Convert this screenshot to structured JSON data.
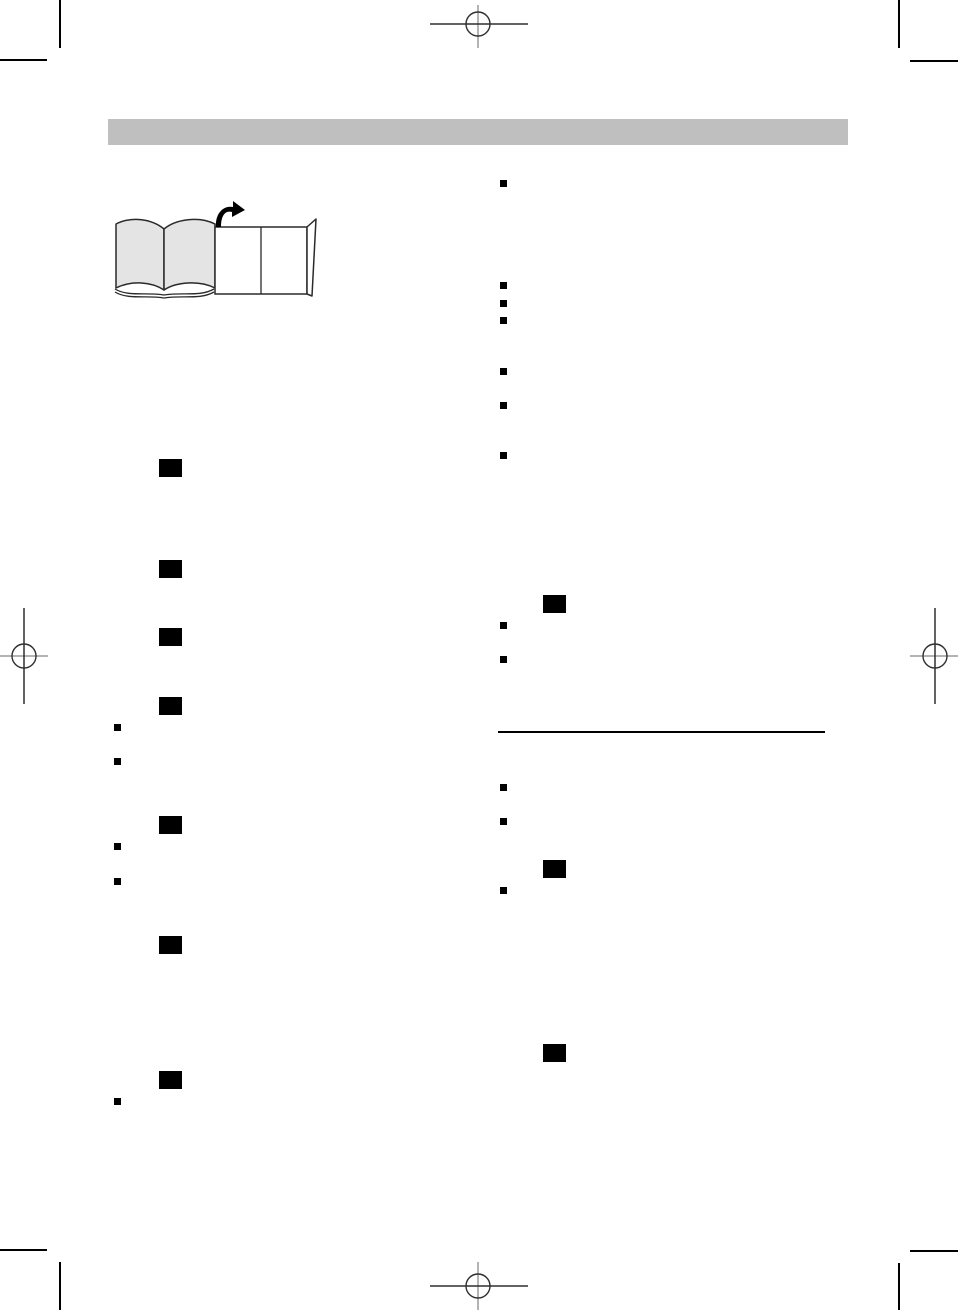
{
  "page": {
    "width": 958,
    "height": 1310,
    "background": "#ffffff"
  },
  "colors": {
    "header_bar": "#bfbfbf",
    "ink": "#000000",
    "crop_mark_dark": "#2f2f2f",
    "crop_mark_gray": "#b3b3b3",
    "illustration_page_fill": "#e4e4e4",
    "foldout_fill": "#ffffff"
  },
  "header_bar": {
    "x": 108,
    "y": 119,
    "width": 740,
    "height": 26
  },
  "illustration": {
    "name": "open-book-with-foldout-page",
    "x": 106,
    "y": 198,
    "width": 220,
    "height": 112
  },
  "divider": {
    "x": 498,
    "y": 731,
    "width": 327,
    "thickness": 2
  },
  "markers": {
    "step_box_size": {
      "w": 23,
      "h": 18
    },
    "bullet_size": {
      "w": 7,
      "h": 7
    },
    "step_boxes": [
      {
        "x": 159,
        "y": 459
      },
      {
        "x": 159,
        "y": 560
      },
      {
        "x": 159,
        "y": 628
      },
      {
        "x": 159,
        "y": 697
      },
      {
        "x": 159,
        "y": 816
      },
      {
        "x": 159,
        "y": 936
      },
      {
        "x": 159,
        "y": 1071
      },
      {
        "x": 543,
        "y": 595
      },
      {
        "x": 543,
        "y": 860
      },
      {
        "x": 543,
        "y": 1044
      }
    ],
    "bullets": [
      {
        "x": 114,
        "y": 724
      },
      {
        "x": 114,
        "y": 758
      },
      {
        "x": 114,
        "y": 843
      },
      {
        "x": 114,
        "y": 878
      },
      {
        "x": 114,
        "y": 1098
      },
      {
        "x": 500,
        "y": 180
      },
      {
        "x": 500,
        "y": 282
      },
      {
        "x": 500,
        "y": 300
      },
      {
        "x": 500,
        "y": 317
      },
      {
        "x": 500,
        "y": 368
      },
      {
        "x": 500,
        "y": 402
      },
      {
        "x": 500,
        "y": 452
      },
      {
        "x": 500,
        "y": 622
      },
      {
        "x": 500,
        "y": 656
      },
      {
        "x": 500,
        "y": 784
      },
      {
        "x": 500,
        "y": 818
      },
      {
        "x": 500,
        "y": 887
      }
    ]
  }
}
